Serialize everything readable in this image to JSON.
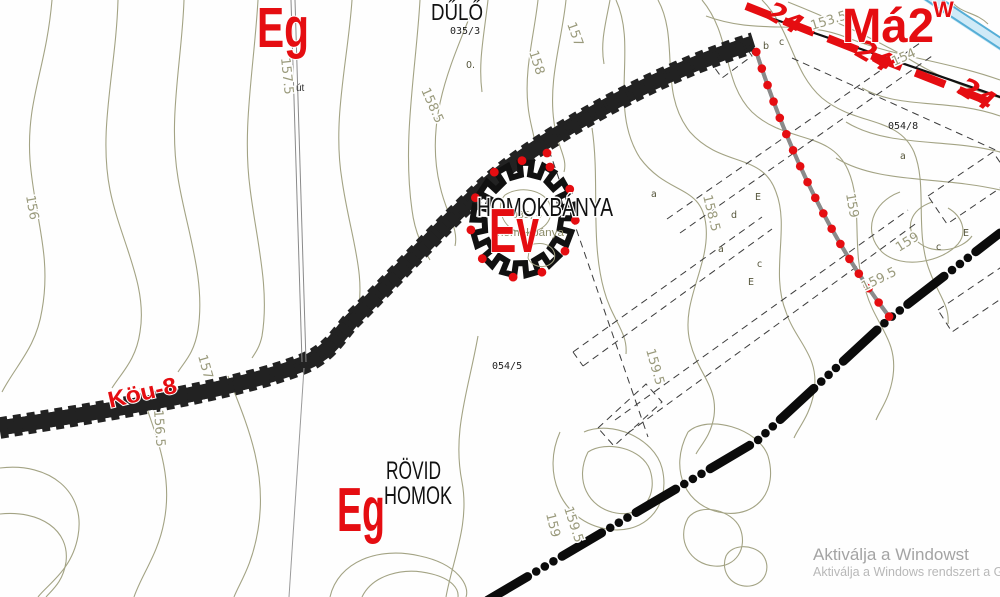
{
  "map": {
    "big_labels": {
      "eg_top": "Eg",
      "ma2": "Má2",
      "w_mark": "W",
      "ev": "Ev",
      "eg_bottom": "Eg",
      "road_name": "Köu-8"
    },
    "place_labels": {
      "dulo": "DŰLŐ",
      "homokbanya": "HOMOKBÁNYA",
      "rovid": "RÖVID",
      "homok": "HOMOK",
      "homokbanya_small": "homokbánya",
      "ut": "út"
    },
    "parcel_labels": [
      {
        "text": "035/3",
        "x": 450,
        "y": 34,
        "olive": false
      },
      {
        "text": "054/8",
        "x": 888,
        "y": 129,
        "olive": false
      },
      {
        "text": "054/5",
        "x": 492,
        "y": 369,
        "olive": false
      },
      {
        "text": "035/4",
        "x": 512,
        "y": 218,
        "olive": true
      }
    ],
    "contour_labels": [
      {
        "text": "156",
        "x": 26,
        "y": 196,
        "rot": 80
      },
      {
        "text": "157",
        "x": 198,
        "y": 356,
        "rot": 74
      },
      {
        "text": "156.5",
        "x": 154,
        "y": 410,
        "rot": 86
      },
      {
        "text": "157.5",
        "x": 281,
        "y": 58,
        "rot": 84
      },
      {
        "text": "158.5",
        "x": 421,
        "y": 90,
        "rot": 66
      },
      {
        "text": "158",
        "x": 529,
        "y": 52,
        "rot": 72
      },
      {
        "text": "157",
        "x": 567,
        "y": 24,
        "rot": 70
      },
      {
        "text": "153.5",
        "x": 812,
        "y": 30,
        "rot": -17
      },
      {
        "text": "154",
        "x": 894,
        "y": 66,
        "rot": -24
      },
      {
        "text": "158.5",
        "x": 703,
        "y": 196,
        "rot": 76
      },
      {
        "text": "159",
        "x": 846,
        "y": 194,
        "rot": 80
      },
      {
        "text": "159",
        "x": 899,
        "y": 252,
        "rot": -32
      },
      {
        "text": "159.5",
        "x": 864,
        "y": 291,
        "rot": -26
      },
      {
        "text": "159.5",
        "x": 646,
        "y": 350,
        "rot": 74
      },
      {
        "text": "159",
        "x": 546,
        "y": 514,
        "rot": 76
      },
      {
        "text": "159.5",
        "x": 564,
        "y": 508,
        "rot": 72
      }
    ],
    "letter_labels": [
      {
        "text": "b",
        "x": 763,
        "y": 49
      },
      {
        "text": "c",
        "x": 779,
        "y": 45
      },
      {
        "text": "a",
        "x": 651,
        "y": 197
      },
      {
        "text": "E",
        "x": 755,
        "y": 200
      },
      {
        "text": "d",
        "x": 731,
        "y": 218
      },
      {
        "text": "a",
        "x": 718,
        "y": 252
      },
      {
        "text": "c",
        "x": 757,
        "y": 267
      },
      {
        "text": "E",
        "x": 748,
        "y": 285
      },
      {
        "text": "a",
        "x": 900,
        "y": 159
      },
      {
        "text": "E",
        "x": 963,
        "y": 236
      },
      {
        "text": "c",
        "x": 936,
        "y": 250
      },
      {
        "text": "0.",
        "x": 466,
        "y": 68
      }
    ],
    "boundary_marks": [
      {
        "text": "24",
        "x": 780,
        "y": 26,
        "rot": 30
      },
      {
        "text": "24",
        "x": 870,
        "y": 64,
        "rot": 30
      },
      {
        "text": "24",
        "x": 972,
        "y": 102,
        "rot": 32
      }
    ],
    "watermark": {
      "line1": "Aktiválja a Windowst",
      "line2": "Aktiválja a Windows rendszert a Gépházba"
    },
    "colors": {
      "red": "#e50d11",
      "road_fill": "#f5f19b",
      "contour": "#a3a384",
      "stream": "#55aed6",
      "stream_fill": "#cfeaf7",
      "watermark": "#a8a8a8",
      "black": "#111111"
    }
  }
}
